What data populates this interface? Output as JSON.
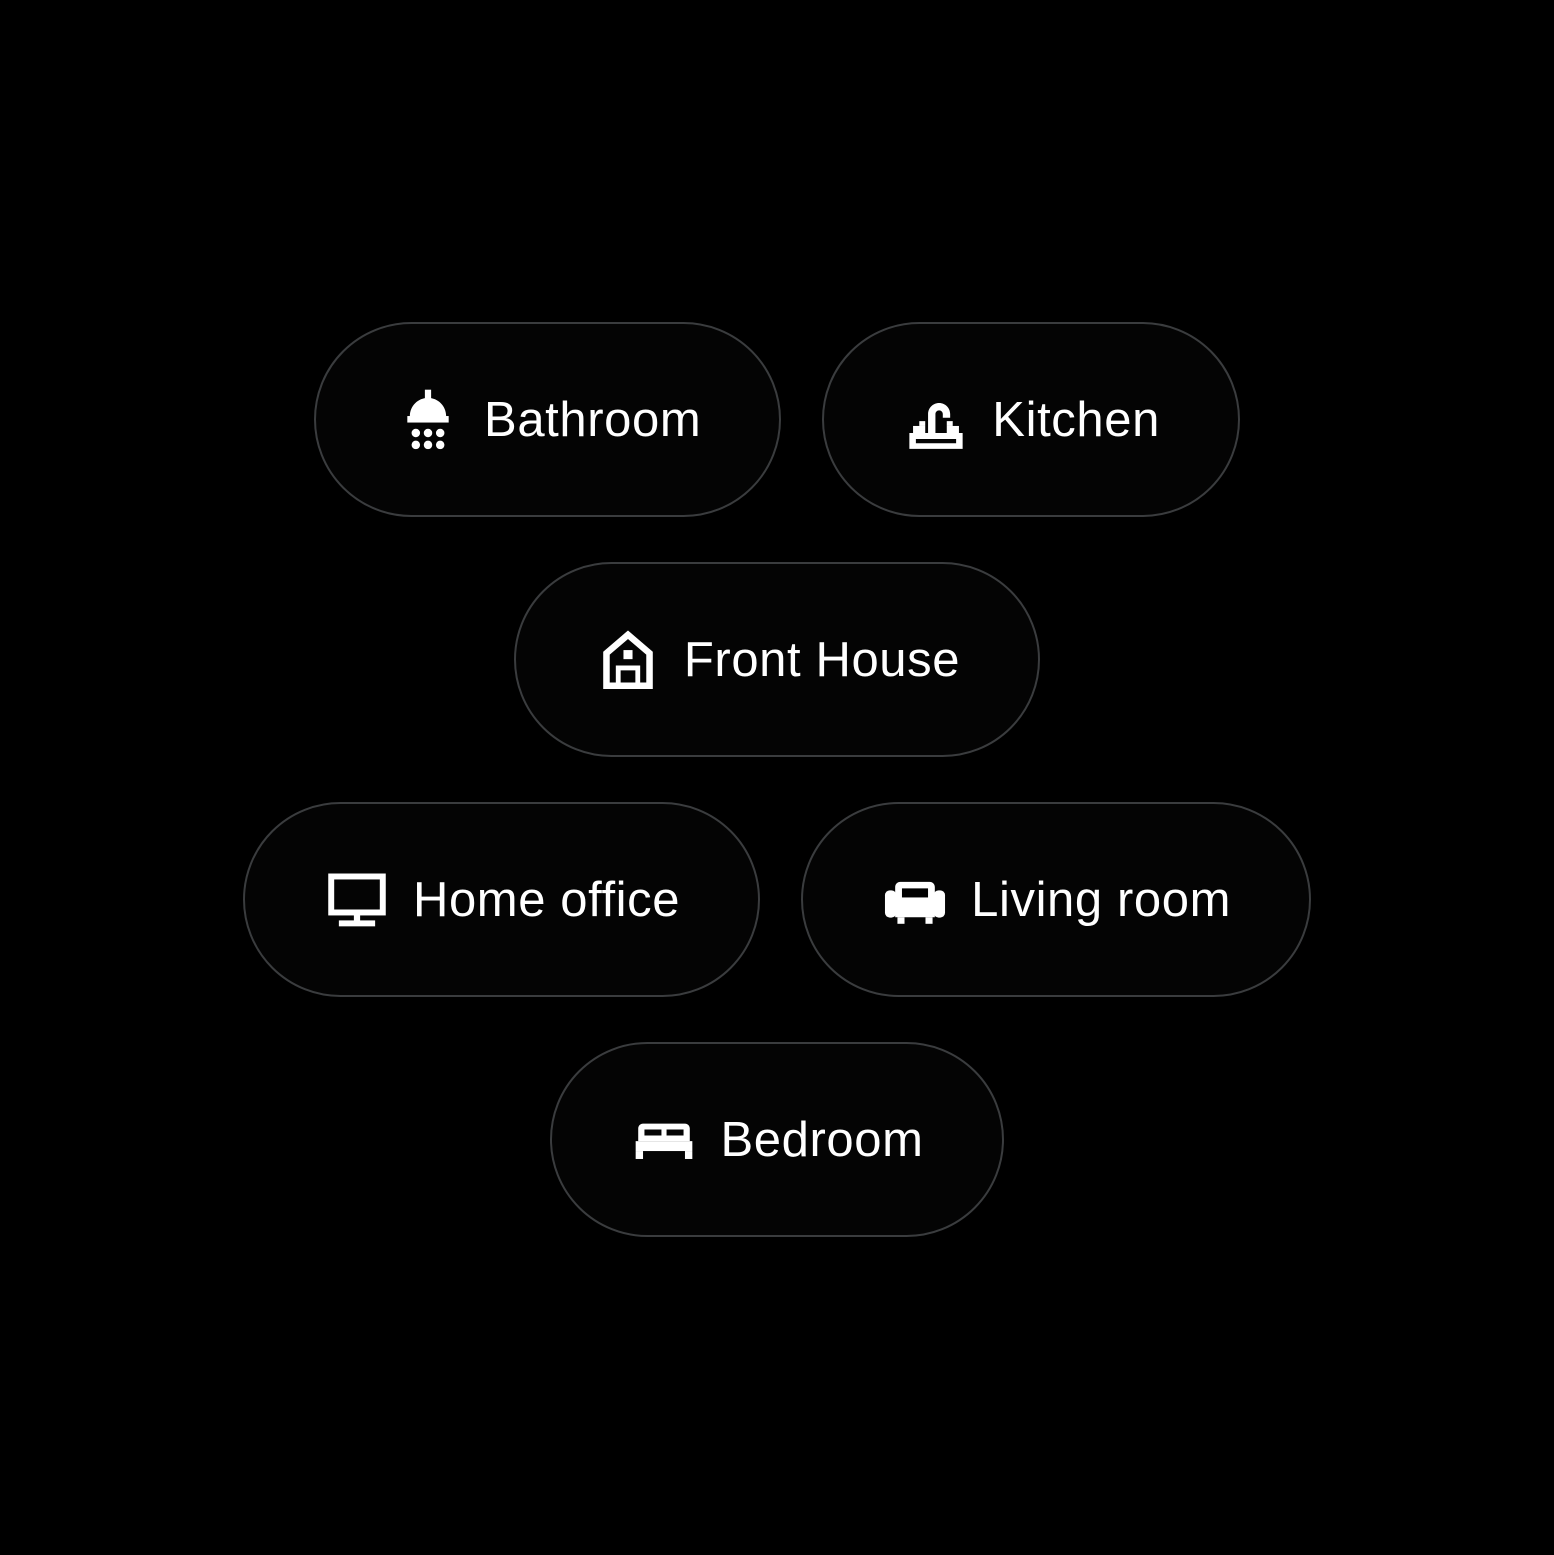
{
  "screen": {
    "background_color": "#000000",
    "chip_border_color": "#3a3c3e",
    "chip_text_color": "#ffffff"
  },
  "rooms": [
    {
      "label": "Bathroom",
      "icon": "shower-icon"
    },
    {
      "label": "Kitchen",
      "icon": "faucet-icon"
    },
    {
      "label": "Front House",
      "icon": "house-icon"
    },
    {
      "label": "Home office",
      "icon": "monitor-icon"
    },
    {
      "label": "Living room",
      "icon": "sofa-icon"
    },
    {
      "label": "Bedroom",
      "icon": "bed-icon"
    }
  ]
}
